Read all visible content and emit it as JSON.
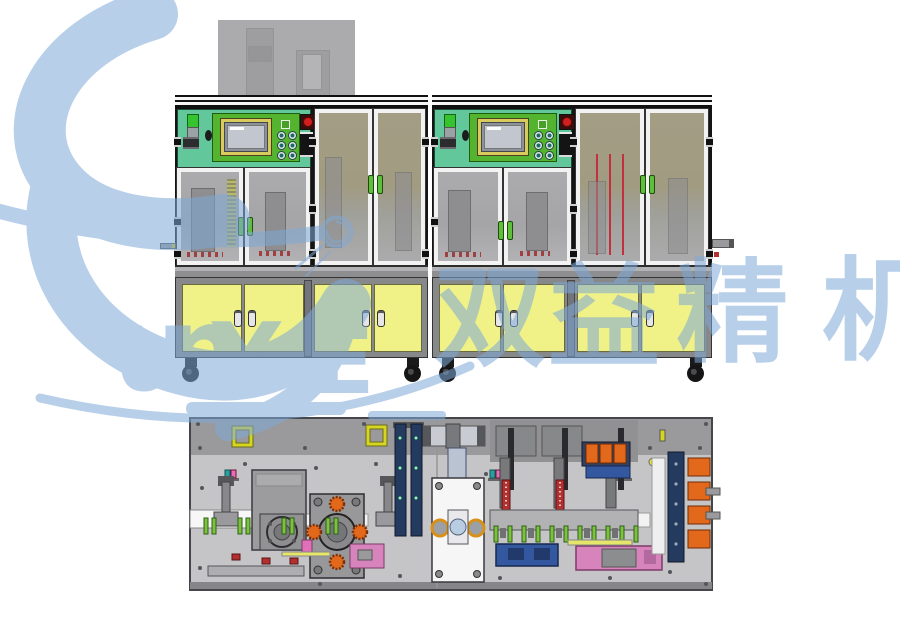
{
  "watermark": {
    "brand": "Sunye",
    "letters": [
      "u",
      "n",
      "Y",
      "E"
    ],
    "cjk_text": "双益精机",
    "cjk_chars": [
      "双",
      "益",
      "精",
      "机"
    ]
  },
  "colors": {
    "watermark_blue": "#7fa9d8",
    "mint": "#63c79c",
    "panel_green": "#54b42f",
    "hmi_frame": "#d9ca5c",
    "screen_gray": "#c2c6ce",
    "estop_red": "#cf1f1f",
    "signal_green": "#35c32f",
    "cabinet_yellow": "#f0f287",
    "frame_light": "#f2f2f2",
    "frame_gray": "#8b8b8d",
    "glass_gray": "#a7a7a9",
    "glass_olive": "#a29c83",
    "base_gray": "#c5c5c7",
    "band_gray": "#9a9a9c",
    "orange": "#e2681c",
    "blue": "#3458a0",
    "navy": "#243b5f",
    "pink": "#d884bc",
    "tab_green": "#7dc23f",
    "handle_green": "#5fbf3a",
    "red_detail": "#b23030",
    "silhouette": "#ababad"
  },
  "views": {
    "front_view_machines": 2,
    "plan_view_machines": 1
  }
}
